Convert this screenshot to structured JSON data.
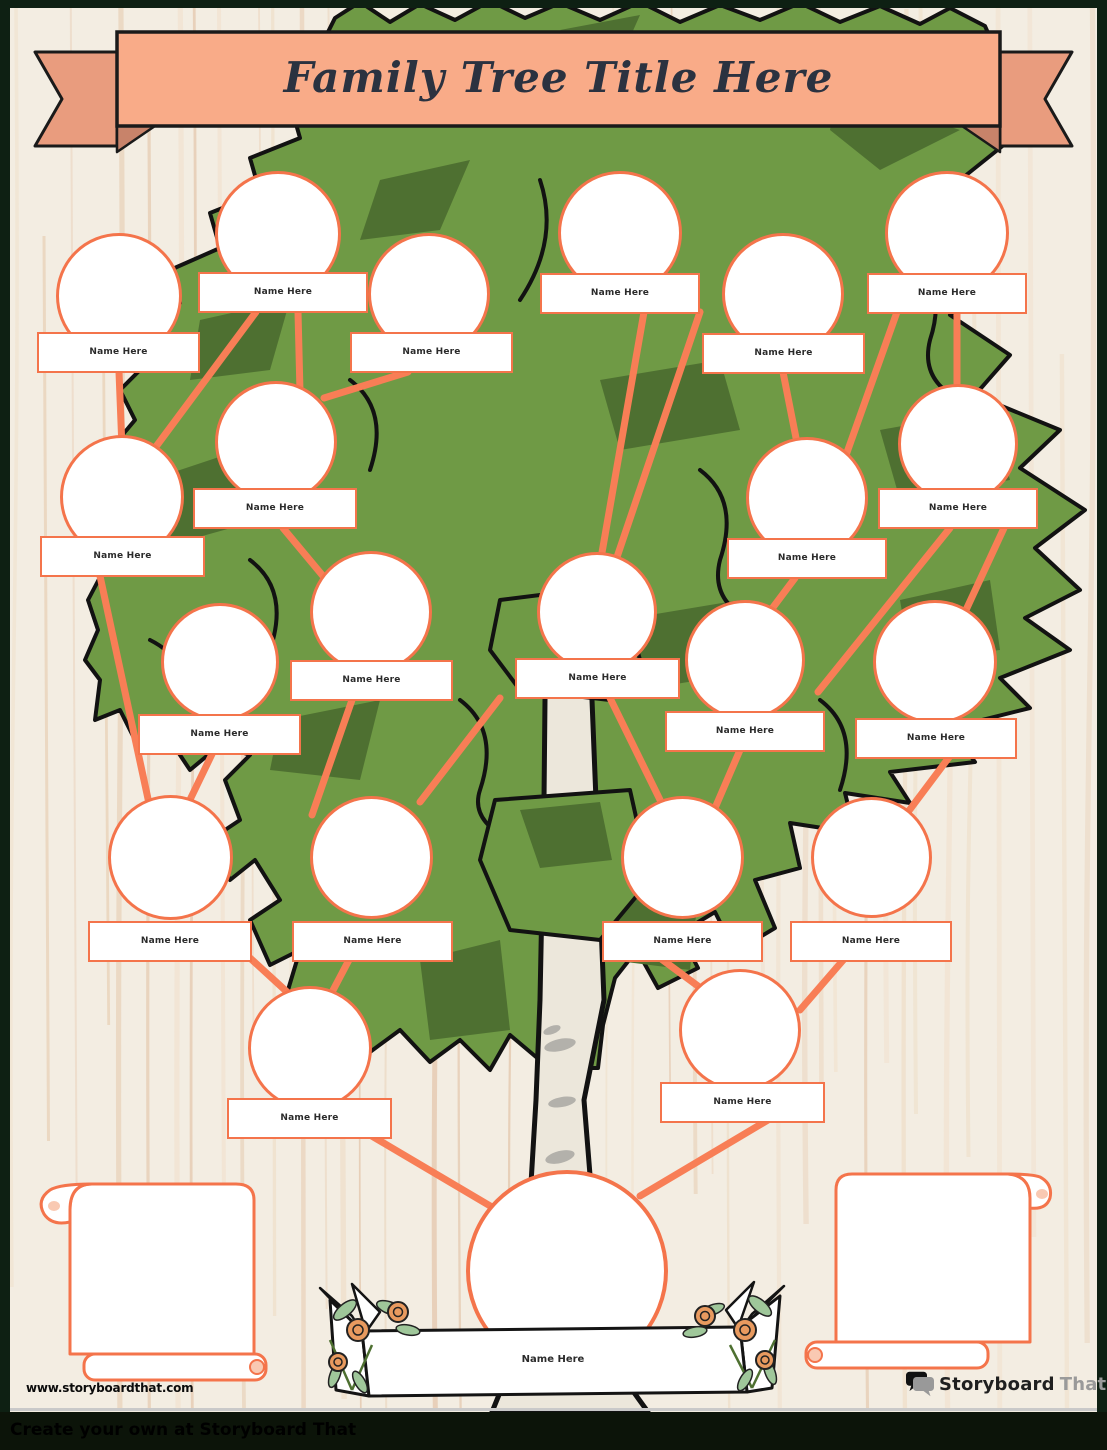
{
  "page": {
    "title_banner": "Family Tree Title Here"
  },
  "members": [
    {
      "label": "Name Here"
    },
    {
      "label": "Name Here"
    },
    {
      "label": "Name Here"
    },
    {
      "label": "Name Here"
    },
    {
      "label": "Name Here"
    },
    {
      "label": "Name Here"
    },
    {
      "label": "Name Here"
    },
    {
      "label": "Name Here"
    },
    {
      "label": "Name Here"
    },
    {
      "label": "Name Here"
    },
    {
      "label": "Name Here"
    },
    {
      "label": "Name Here"
    },
    {
      "label": "Name Here"
    },
    {
      "label": "Name Here"
    },
    {
      "label": "Name Here"
    },
    {
      "label": "Name Here"
    },
    {
      "label": "Name Here"
    },
    {
      "label": "Name Here"
    },
    {
      "label": "Name Here"
    },
    {
      "label": "Name Here"
    },
    {
      "label": "Name Here"
    }
  ],
  "root": {
    "label": "Name Here"
  },
  "footer": {
    "website": "www.storyboardthat.com",
    "tagline": "Create your own at Storyboard That"
  },
  "logo": {
    "part1": "Storyboard",
    "part2": "That"
  },
  "colors": {
    "accent_orange": "#F4744B",
    "connector_orange": "#F87E56",
    "canopy_green": "#6F9A45",
    "canopy_dark_green": "#4E7031",
    "trunk_cream": "#ECE7DB",
    "banner_fill": "#F9AB88",
    "banner_tail": "#E99C7E",
    "banner_fold": "#C8836A",
    "title_text": "#2B3240",
    "background_cream": "#F3EDE2",
    "frame_dark_green": "#0E2013",
    "footer_bar": "#0C1409",
    "rose": "#E89A5F",
    "leaf_green": "#9FC79A"
  }
}
